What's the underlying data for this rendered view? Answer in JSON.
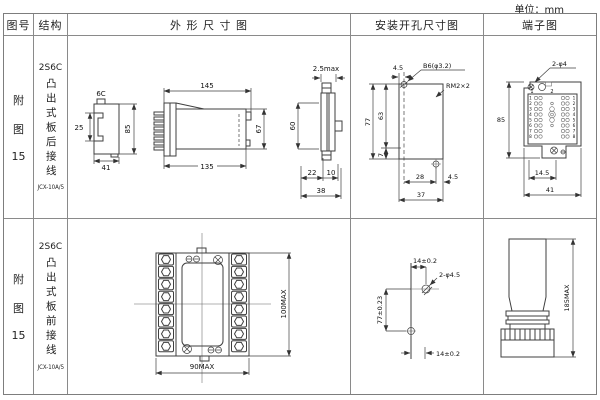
{
  "unit_label": "单位：mm",
  "colors": {
    "line": "#3f3f3f",
    "border": "#8a8a8a",
    "text": "#1a1a1a",
    "background": "#ffffff"
  },
  "header": {
    "figure": "图号",
    "structure": "结构",
    "outline": "外 形 尺 寸 图",
    "mounting": "安装开孔尺寸图",
    "terminal": "端子图"
  },
  "rows": [
    {
      "figure_lines": [
        "附",
        "图",
        "15"
      ],
      "structure": {
        "model": "2S6C",
        "mount_type": "凸出式板后接线",
        "code": "JCX-10A/5"
      },
      "outline": {
        "front": {
          "top_label": "6C",
          "left": "25",
          "right": "85",
          "bottom": "41"
        },
        "side": {
          "top": "145",
          "bottom": "135",
          "right": "67"
        },
        "edge": {
          "top": "2.5max",
          "left": "60",
          "seg1": "22",
          "seg2": "10",
          "total": "38"
        }
      },
      "mounting": {
        "left_offset": "4.5",
        "hole_label": "B6(φ3.2)",
        "thread_label": "RM2×2",
        "total_h": "77",
        "inner_h": "63",
        "bottom_h": "7",
        "inner_w": "28",
        "right_offset": "4.5",
        "total_w": "37"
      },
      "terminal": {
        "hole_label": "2-φ4",
        "height": "85",
        "inner_w": "14.5",
        "total_w": "41",
        "col1": "1",
        "col2": "2",
        "row_labels": [
          "1",
          "2",
          "3",
          "4",
          "5",
          "6",
          "7",
          "8"
        ]
      }
    },
    {
      "figure_lines": [
        "附",
        "图",
        "15"
      ],
      "structure": {
        "model": "2S6C",
        "mount_type": "凸出式板前接线",
        "code": "JCX-10A/5"
      },
      "outline": {
        "bottom": "90MAX",
        "right": "100MAX"
      },
      "mounting": {
        "top": "14±0.2",
        "hole_label": "2-φ4.5",
        "height": "77±0.23",
        "bottom": "14±0.2"
      },
      "terminal": {
        "height": "185MAX"
      }
    }
  ]
}
